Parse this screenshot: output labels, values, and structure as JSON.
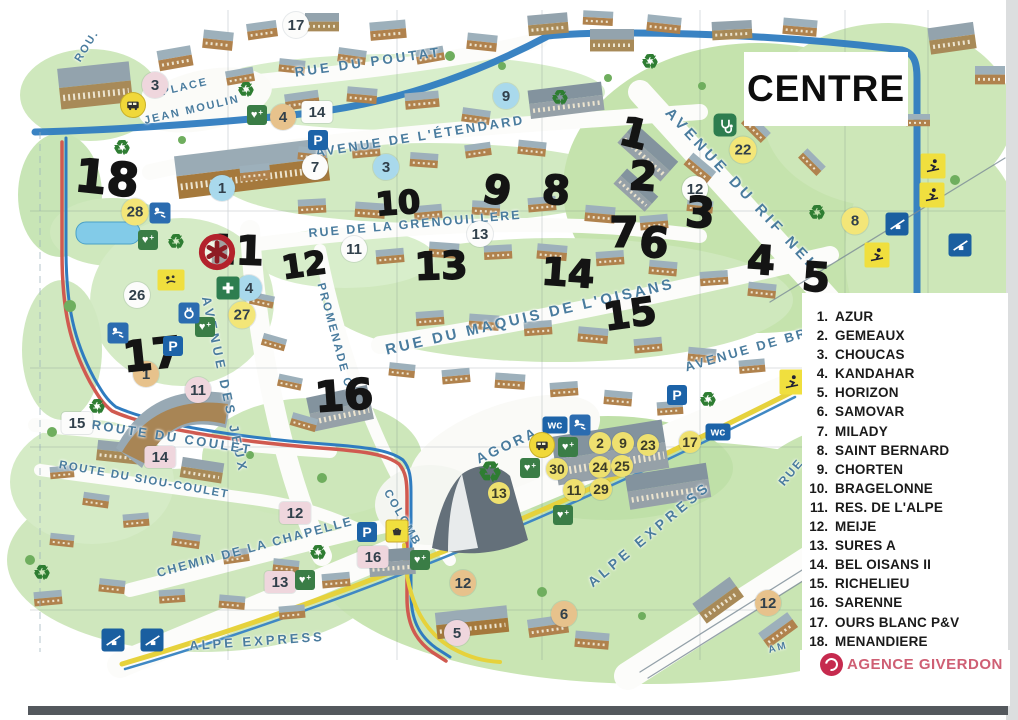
{
  "title": "CENTRE",
  "agency": {
    "name": "AGENCE GIVERDON",
    "color": "#cf5f74"
  },
  "colors": {
    "handwriting": "#141414",
    "street_label": "#4a7c9e",
    "road_blue": "#2f7cc0",
    "road_red": "#d05a50",
    "lift_yellow": "#e6d23c",
    "legend_text": "#1a1a1a"
  },
  "legend": {
    "items": [
      {
        "num": "1.",
        "name": "AZUR"
      },
      {
        "num": "2.",
        "name": "GEMEAUX"
      },
      {
        "num": "3.",
        "name": "CHOUCAS"
      },
      {
        "num": "4.",
        "name": "KANDAHAR"
      },
      {
        "num": "5.",
        "name": "HORIZON"
      },
      {
        "num": "6.",
        "name": "SAMOVAR"
      },
      {
        "num": "7.",
        "name": "MILADY"
      },
      {
        "num": "8.",
        "name": "SAINT BERNARD"
      },
      {
        "num": "9.",
        "name": "CHORTEN"
      },
      {
        "num": "10.",
        "name": "BRAGELONNE"
      },
      {
        "num": "11.",
        "name": "RES. DE L'ALPE"
      },
      {
        "num": "12.",
        "name": "MEIJE"
      },
      {
        "num": "13.",
        "name": "SURES A"
      },
      {
        "num": "14.",
        "name": "BEL OISANS II"
      },
      {
        "num": "15.",
        "name": "RICHELIEU"
      },
      {
        "num": "16.",
        "name": "SARENNE"
      },
      {
        "num": "17.",
        "name": "OURS BLANC P&V"
      },
      {
        "num": "18.",
        "name": "MENANDIERE"
      }
    ]
  },
  "map": {
    "streets": [
      {
        "text": "ROU.",
        "x": 87,
        "y": 46,
        "rot": -58,
        "fs": 11,
        "ls": 2
      },
      {
        "text": "RUE DU POUTAT",
        "x": 368,
        "y": 62,
        "rot": -8,
        "fs": 13.5,
        "ls": 3
      },
      {
        "text": "PLACE",
        "x": 185,
        "y": 87,
        "rot": -13,
        "fs": 11,
        "ls": 2
      },
      {
        "text": "JEAN MOULIN",
        "x": 192,
        "y": 110,
        "rot": -13,
        "fs": 11,
        "ls": 2
      },
      {
        "text": "AVENUE DE L'ÉTENDARD",
        "x": 420,
        "y": 136,
        "rot": -9,
        "fs": 13,
        "ls": 2.5
      },
      {
        "text": "RUE DE LA GRENOUILLERE",
        "x": 415,
        "y": 224,
        "rot": -5,
        "fs": 12.5,
        "ls": 2
      },
      {
        "text": "AVENUE DU RIF NEL",
        "x": 742,
        "y": 190,
        "rot": 47,
        "fs": 15,
        "ls": 4
      },
      {
        "text": "RUE DU MAQUIS DE L'OISANS",
        "x": 530,
        "y": 317,
        "rot": -13,
        "fs": 15,
        "ls": 3
      },
      {
        "text": "AVENUE DE BRA",
        "x": 752,
        "y": 348,
        "rot": -16,
        "fs": 13,
        "ls": 2.5
      },
      {
        "text": "AVENUE DES JEUX",
        "x": 225,
        "y": 385,
        "rot": 78,
        "fs": 13,
        "ls": 4
      },
      {
        "text": "PROMENADE C.",
        "x": 335,
        "y": 338,
        "rot": 75,
        "fs": 11.5,
        "ls": 2
      },
      {
        "text": "COLOMB",
        "x": 402,
        "y": 518,
        "rot": 60,
        "fs": 11.5,
        "ls": 2
      },
      {
        "text": "ROUTE DU COULET",
        "x": 172,
        "y": 437,
        "rot": 9,
        "fs": 13,
        "ls": 2.5
      },
      {
        "text": "ROUTE DU SIOU-COULET",
        "x": 144,
        "y": 480,
        "rot": 10,
        "fs": 11.5,
        "ls": 1.5
      },
      {
        "text": "CHEMIN DE LA CHAPELLE",
        "x": 255,
        "y": 547,
        "rot": -15,
        "fs": 12.5,
        "ls": 2
      },
      {
        "text": "AGORA",
        "x": 507,
        "y": 445,
        "rot": -25,
        "fs": 14,
        "ls": 3
      },
      {
        "text": "ALPE EXPRESS",
        "x": 257,
        "y": 641,
        "rot": -4,
        "fs": 13,
        "ls": 3
      },
      {
        "text": "ALPE EXPRESS",
        "x": 649,
        "y": 534,
        "rot": -40,
        "fs": 14,
        "ls": 4
      },
      {
        "text": "RUE",
        "x": 791,
        "y": 472,
        "rot": -50,
        "fs": 12,
        "ls": 2
      },
      {
        "text": "AM",
        "x": 778,
        "y": 648,
        "rot": -15,
        "fs": 10,
        "ls": 2
      }
    ],
    "handwritten": [
      {
        "t": "18",
        "x": 107,
        "y": 178,
        "s": 46,
        "r": 6
      },
      {
        "t": "11",
        "x": 236,
        "y": 251,
        "s": 40,
        "r": 2
      },
      {
        "t": "12",
        "x": 304,
        "y": 265,
        "s": 32,
        "r": -8
      },
      {
        "t": "10",
        "x": 398,
        "y": 203,
        "s": 32,
        "r": -4
      },
      {
        "t": "9",
        "x": 497,
        "y": 191,
        "s": 40,
        "r": 12
      },
      {
        "t": "8",
        "x": 556,
        "y": 191,
        "s": 40,
        "r": 4
      },
      {
        "t": "13",
        "x": 441,
        "y": 266,
        "s": 38,
        "r": -2
      },
      {
        "t": "14",
        "x": 568,
        "y": 273,
        "s": 38,
        "r": 4
      },
      {
        "t": "1",
        "x": 634,
        "y": 134,
        "s": 40,
        "r": 14
      },
      {
        "t": "2",
        "x": 643,
        "y": 177,
        "s": 40,
        "r": 4
      },
      {
        "t": "3",
        "x": 700,
        "y": 213,
        "s": 42,
        "r": 4
      },
      {
        "t": "7",
        "x": 624,
        "y": 233,
        "s": 42,
        "r": 0
      },
      {
        "t": "6",
        "x": 654,
        "y": 243,
        "s": 42,
        "r": 6
      },
      {
        "t": "4",
        "x": 761,
        "y": 261,
        "s": 40,
        "r": 4
      },
      {
        "t": "5",
        "x": 816,
        "y": 278,
        "s": 40,
        "r": 4
      },
      {
        "t": "15",
        "x": 630,
        "y": 314,
        "s": 38,
        "r": -8
      },
      {
        "t": "16",
        "x": 344,
        "y": 396,
        "s": 42,
        "r": -4
      },
      {
        "t": "17",
        "x": 152,
        "y": 355,
        "s": 42,
        "r": -6
      }
    ],
    "markers": [
      {
        "t": "17",
        "x": 296,
        "y": 25,
        "v": "wc"
      },
      {
        "t": "7",
        "x": 315,
        "y": 167,
        "v": "wc"
      },
      {
        "t": "26",
        "x": 137,
        "y": 295,
        "v": "wc"
      },
      {
        "t": "12",
        "x": 695,
        "y": 189,
        "v": "wc"
      },
      {
        "t": "13",
        "x": 480,
        "y": 234,
        "v": "wc"
      },
      {
        "t": "11",
        "x": 354,
        "y": 249,
        "v": "wc"
      },
      {
        "t": "3",
        "x": 155,
        "y": 85,
        "v": "pc"
      },
      {
        "t": "11",
        "x": 198,
        "y": 390,
        "v": "pc"
      },
      {
        "t": "5",
        "x": 457,
        "y": 633,
        "v": "pc"
      },
      {
        "t": "9",
        "x": 506,
        "y": 96,
        "v": "bc"
      },
      {
        "t": "1",
        "x": 222,
        "y": 188,
        "v": "bc"
      },
      {
        "t": "3",
        "x": 386,
        "y": 167,
        "v": "bc"
      },
      {
        "t": "4",
        "x": 249,
        "y": 288,
        "v": "bc"
      },
      {
        "t": "4",
        "x": 283,
        "y": 117,
        "v": "tc"
      },
      {
        "t": "1",
        "x": 146,
        "y": 374,
        "v": "tc"
      },
      {
        "t": "12",
        "x": 463,
        "y": 583,
        "v": "tc"
      },
      {
        "t": "6",
        "x": 564,
        "y": 614,
        "v": "tc"
      },
      {
        "t": "12",
        "x": 768,
        "y": 603,
        "v": "tc"
      },
      {
        "t": "22",
        "x": 743,
        "y": 150,
        "v": "yc"
      },
      {
        "t": "8",
        "x": 855,
        "y": 221,
        "v": "yc"
      },
      {
        "t": "28",
        "x": 135,
        "y": 212,
        "v": "yc"
      },
      {
        "t": "27",
        "x": 242,
        "y": 315,
        "v": "yc"
      },
      {
        "t": "2",
        "x": 600,
        "y": 443,
        "v": "ys"
      },
      {
        "t": "9",
        "x": 623,
        "y": 443,
        "v": "ys"
      },
      {
        "t": "23",
        "x": 648,
        "y": 445,
        "v": "ys"
      },
      {
        "t": "17",
        "x": 690,
        "y": 442,
        "v": "ys"
      },
      {
        "t": "30",
        "x": 557,
        "y": 469,
        "v": "ys"
      },
      {
        "t": "24",
        "x": 600,
        "y": 467,
        "v": "ys"
      },
      {
        "t": "25",
        "x": 622,
        "y": 466,
        "v": "ys"
      },
      {
        "t": "11",
        "x": 574,
        "y": 490,
        "v": "ys"
      },
      {
        "t": "29",
        "x": 601,
        "y": 489,
        "v": "ys"
      },
      {
        "t": "13",
        "x": 499,
        "y": 493,
        "v": "ys"
      },
      {
        "t": "14",
        "x": 317,
        "y": 112,
        "v": "wb"
      },
      {
        "t": "15",
        "x": 77,
        "y": 423,
        "v": "wb"
      },
      {
        "t": "14",
        "x": 160,
        "y": 457,
        "v": "pb"
      },
      {
        "t": "12",
        "x": 295,
        "y": 513,
        "v": "pb"
      },
      {
        "t": "13",
        "x": 280,
        "y": 582,
        "v": "pb"
      },
      {
        "t": "16",
        "x": 373,
        "y": 557,
        "v": "pb"
      }
    ],
    "icons": [
      {
        "type": "recycle",
        "label": "♻",
        "x": 246,
        "y": 90
      },
      {
        "type": "recycle",
        "label": "♻",
        "x": 122,
        "y": 148
      },
      {
        "type": "recycle",
        "label": "♻",
        "x": 176,
        "y": 242
      },
      {
        "type": "recycle",
        "label": "♻",
        "x": 560,
        "y": 98
      },
      {
        "type": "recycle",
        "label": "♻",
        "x": 817,
        "y": 213
      },
      {
        "type": "recycle",
        "label": "♻",
        "x": 650,
        "y": 62
      },
      {
        "type": "recycle",
        "label": "♻",
        "x": 490,
        "y": 472,
        "s": 28
      },
      {
        "type": "recycle",
        "label": "♻",
        "x": 318,
        "y": 553
      },
      {
        "type": "recycle",
        "label": "♻",
        "x": 42,
        "y": 573
      },
      {
        "type": "recycle",
        "label": "♻",
        "x": 97,
        "y": 407
      },
      {
        "type": "recycle",
        "label": "♻",
        "x": 708,
        "y": 400
      },
      {
        "type": "heart",
        "label": "♥",
        "x": 148,
        "y": 240
      },
      {
        "type": "heart",
        "label": "♥",
        "x": 257,
        "y": 115
      },
      {
        "type": "heart",
        "label": "♥",
        "x": 205,
        "y": 327
      },
      {
        "type": "heart",
        "label": "♥",
        "x": 420,
        "y": 560
      },
      {
        "type": "heart",
        "label": "♥",
        "x": 530,
        "y": 468
      },
      {
        "type": "heart",
        "label": "♥",
        "x": 568,
        "y": 447
      },
      {
        "type": "heart",
        "label": "♥",
        "x": 563,
        "y": 515
      },
      {
        "type": "heart",
        "label": "♥",
        "x": 305,
        "y": 580
      },
      {
        "type": "parking",
        "label": "P",
        "x": 318,
        "y": 140
      },
      {
        "type": "parking",
        "label": "P",
        "x": 173,
        "y": 346
      },
      {
        "type": "parking",
        "label": "P",
        "x": 677,
        "y": 395
      },
      {
        "type": "parking",
        "label": "P",
        "x": 367,
        "y": 532
      },
      {
        "type": "wc",
        "label": "wc",
        "x": 555,
        "y": 425
      },
      {
        "type": "wc",
        "label": "wc",
        "x": 718,
        "y": 432
      },
      {
        "type": "wc",
        "label": "wc",
        "x": 903,
        "y": 432
      },
      {
        "type": "baby",
        "x": 160,
        "y": 213
      },
      {
        "type": "baby",
        "x": 118,
        "y": 333
      },
      {
        "type": "baby",
        "x": 580,
        "y": 425
      },
      {
        "type": "bus",
        "x": 133,
        "y": 105
      },
      {
        "type": "bus",
        "x": 542,
        "y": 445
      },
      {
        "type": "pharmacy",
        "x": 228,
        "y": 288
      },
      {
        "type": "plug",
        "x": 189,
        "y": 313
      },
      {
        "type": "medic",
        "x": 725,
        "y": 125
      },
      {
        "type": "lift",
        "x": 897,
        "y": 224
      },
      {
        "type": "lift",
        "x": 960,
        "y": 245
      },
      {
        "type": "lift",
        "x": 113,
        "y": 640
      },
      {
        "type": "lift",
        "x": 152,
        "y": 640
      },
      {
        "type": "sport",
        "name": "tennis-icon",
        "x": 933,
        "y": 166
      },
      {
        "type": "sport",
        "name": "snowboard-icon",
        "x": 932,
        "y": 195
      },
      {
        "type": "sport",
        "name": "ski-jumper-icon",
        "x": 877,
        "y": 255
      },
      {
        "type": "sport",
        "name": "skier-icon",
        "x": 792,
        "y": 382
      },
      {
        "type": "pets",
        "x": 171,
        "y": 280
      },
      {
        "type": "basket",
        "x": 397,
        "y": 531
      },
      {
        "type": "target",
        "x": 217,
        "y": 252
      }
    ]
  }
}
